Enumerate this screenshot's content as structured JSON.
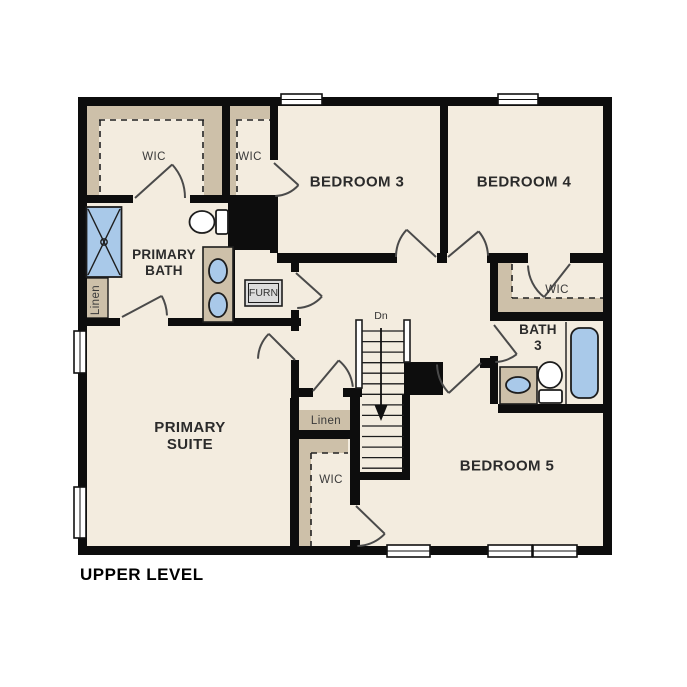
{
  "plan": {
    "caption": "UPPER LEVEL"
  },
  "rooms": {
    "primary_suite": {
      "line1": "PRIMARY",
      "line2": "SUITE"
    },
    "primary_bath": {
      "line1": "PRIMARY",
      "line2": "BATH"
    },
    "bedroom3": {
      "label": "BEDROOM 3"
    },
    "bedroom4": {
      "label": "BEDROOM 4"
    },
    "bedroom5": {
      "label": "BEDROOM 5"
    },
    "bath3": {
      "line1": "BATH",
      "line2": "3"
    },
    "wic_primary_bath": {
      "label": "WIC"
    },
    "wic_bedroom3": {
      "label": "WIC"
    },
    "wic_bedroom4": {
      "label": "WIC"
    },
    "wic_bedroom5": {
      "label": "WIC"
    },
    "linen_primary": {
      "label": "Linen"
    },
    "linen_hall": {
      "label": "Linen"
    },
    "furnace_closet": {
      "label": "FURN"
    },
    "stairs": {
      "direction_label": "Dn"
    }
  },
  "colors": {
    "wall": "#0d0d0d",
    "floor": "#f3ecdf",
    "closet_shelf": "#cdc0a9",
    "fixture_blue": "#a9c9e9"
  }
}
